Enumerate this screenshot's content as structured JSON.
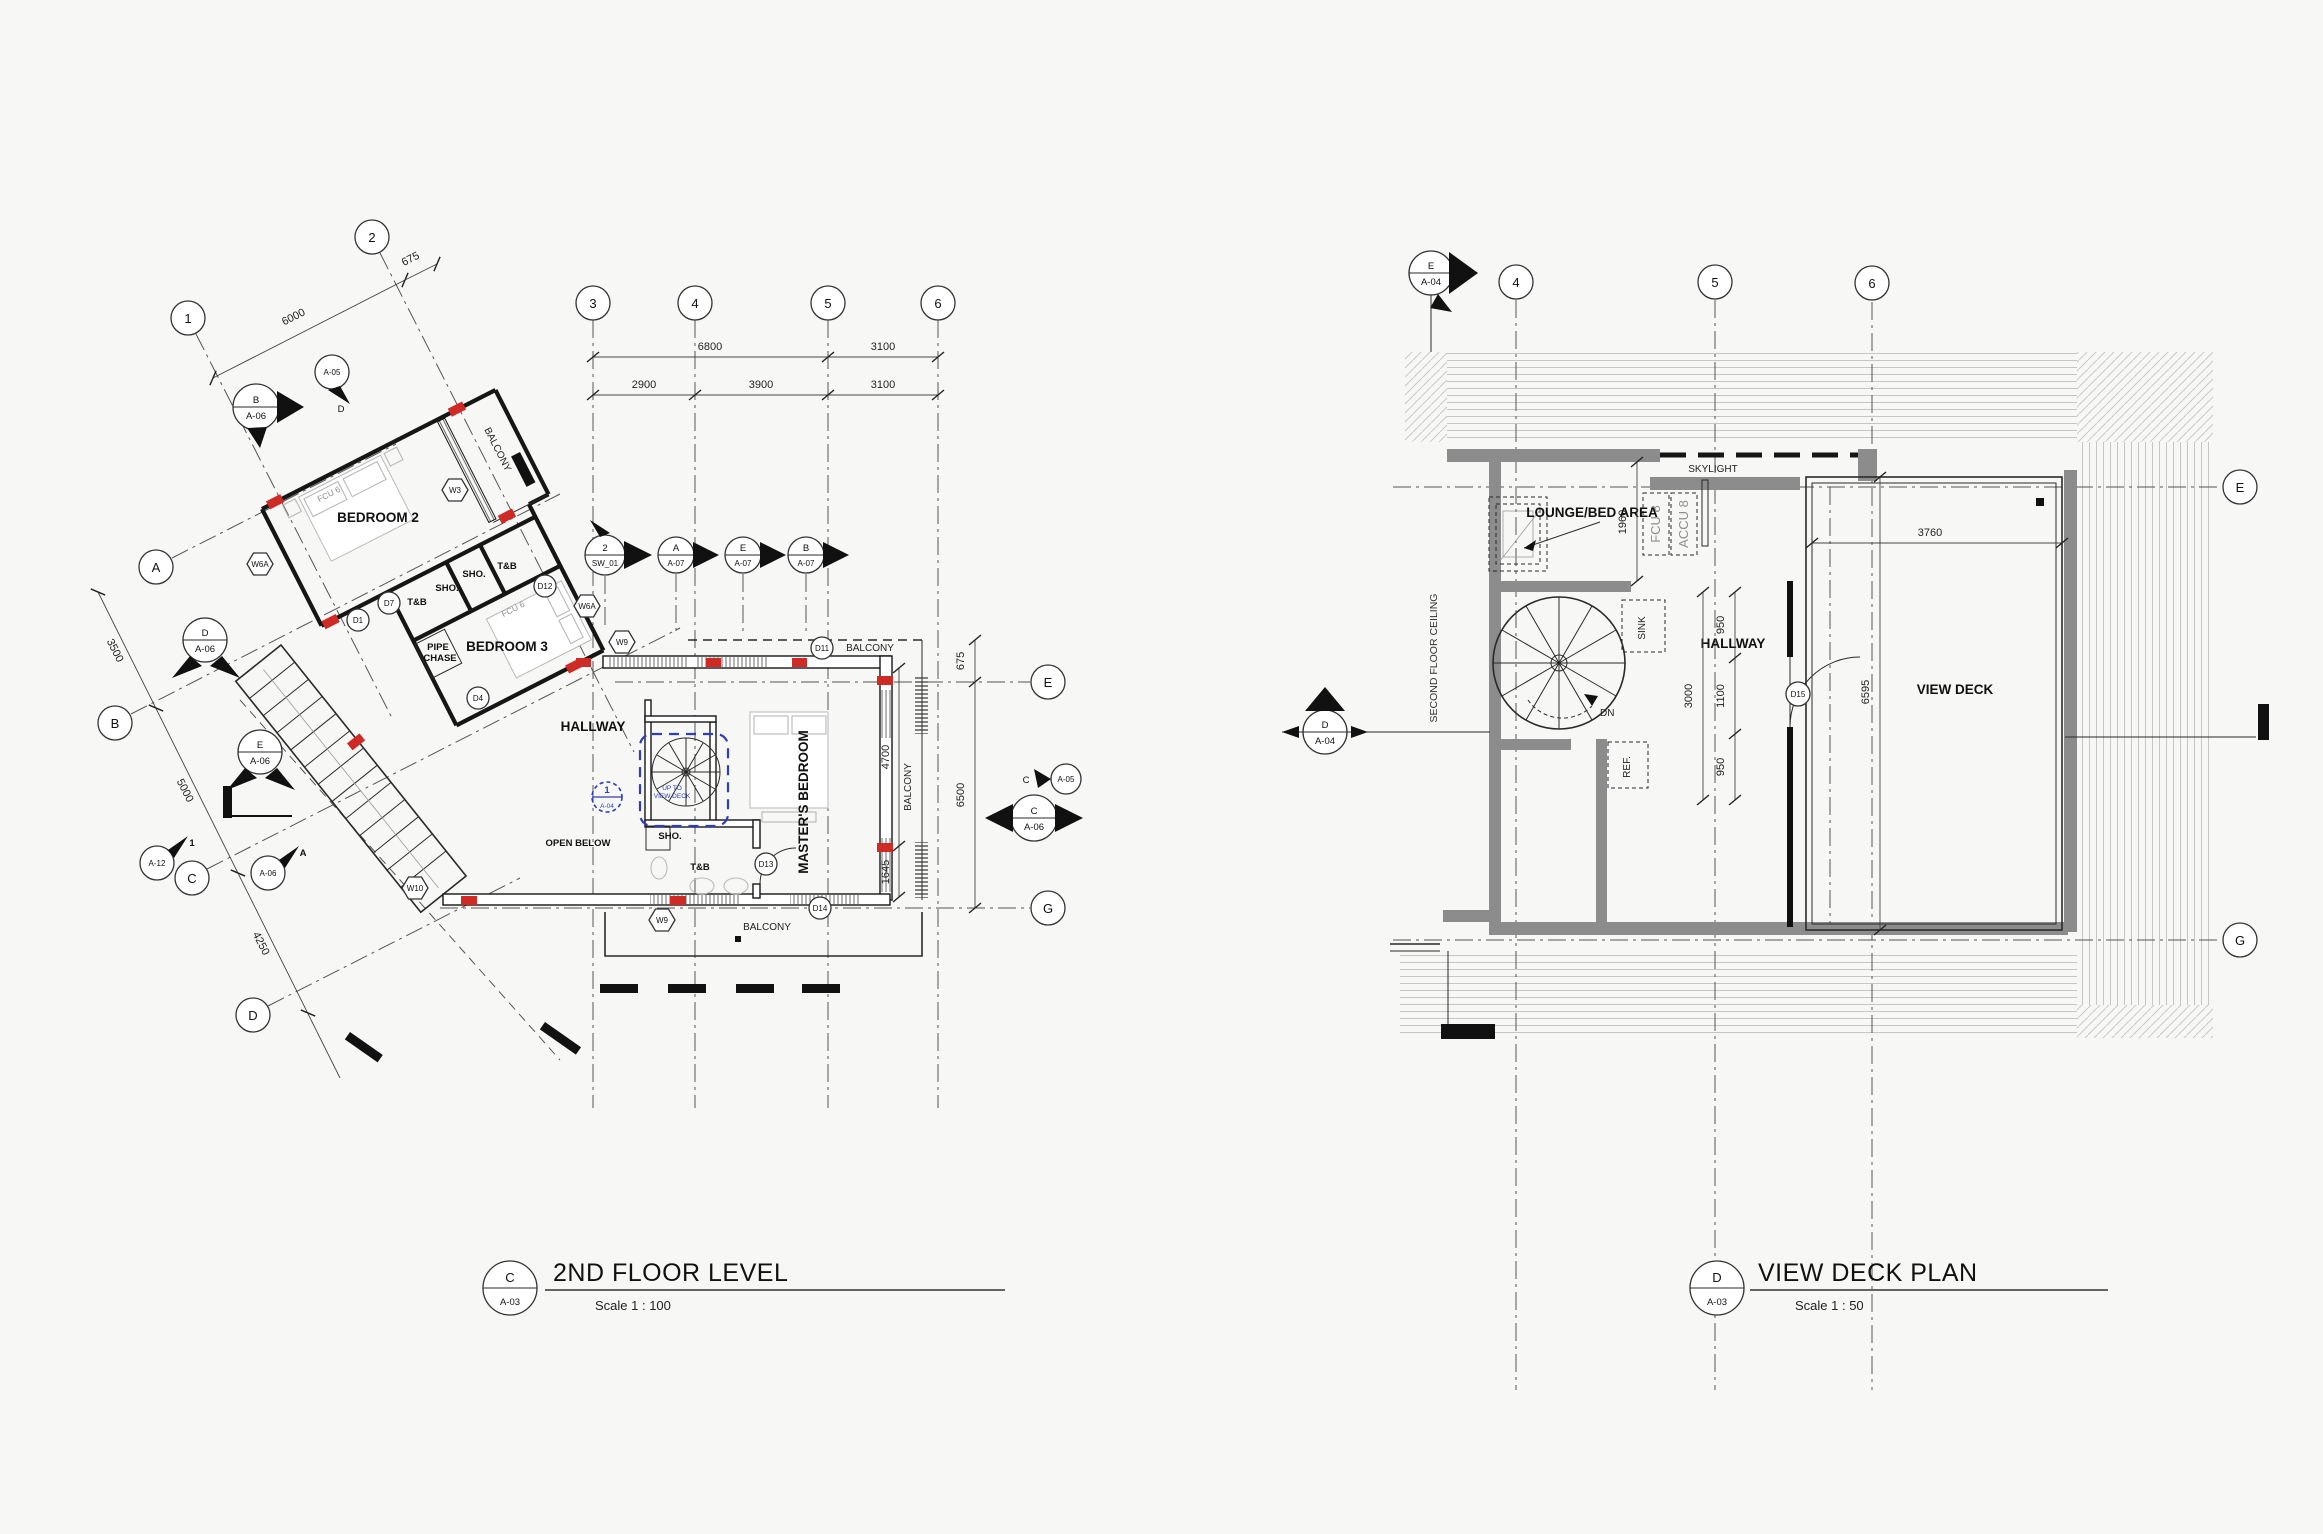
{
  "colors": {
    "red": "#cf2b26",
    "blue": "#2e3eb8",
    "wall_gray": "#8c8c8c",
    "hatch_gray": "#c6c6c6",
    "line": "#1a1a1a"
  },
  "left": {
    "title": {
      "ref": "C",
      "sheet": "A-03",
      "text": "2ND FLOOR LEVEL",
      "scale": "Scale  1 : 100"
    },
    "grids": {
      "n1": "1",
      "n2": "2",
      "n3": "3",
      "n4": "4",
      "n5": "5",
      "n6": "6",
      "la": "A",
      "lb": "B",
      "lc": "C",
      "ld": "D",
      "le": "E",
      "lg": "G"
    },
    "dims": {
      "top6800": "6800",
      "top3100": "3100",
      "r2900": "2900",
      "r3900": "3900",
      "r3100": "3100",
      "d6000": "6000",
      "d675a": "675",
      "d3500": "3500",
      "d5000": "5000",
      "d4250": "4250",
      "d675b": "675",
      "d6500": "6500",
      "d4700": "4700",
      "d1645": "1645"
    },
    "rooms": {
      "bedroom2": "BEDROOM 2",
      "tb1": "T&B",
      "sho1": "SHO.",
      "sho2": "SHO.",
      "tb2": "T&B",
      "bedroom3": "BEDROOM 3",
      "pipe1": "PIPE",
      "pipe2": "CHASE",
      "hallway": "HALLWAY",
      "open_below": "OPEN BELOW",
      "master": "MASTER'S BEDROOM",
      "tb3": "T&B",
      "sho3": "SHO.",
      "balcony_wing": "BALCONY",
      "balcony_top": "BALCONY",
      "balcony_right": "BALCONY",
      "balcony_bottom": "BALCONY",
      "fcu_a": "FCU 6",
      "fcu_b": "FCU 6"
    },
    "notes": {
      "up1": "UP TO",
      "up2": "VIEW DECK"
    },
    "markers": {
      "b_a06": [
        "B",
        "A-06"
      ],
      "a05d": [
        "A-05",
        "D"
      ],
      "d_a06": [
        "D",
        "A-06"
      ],
      "e_a06": [
        "E",
        "A-06"
      ],
      "a12": [
        "A-12",
        "1"
      ],
      "a06a": [
        "A-06",
        "A"
      ],
      "c_a06": [
        "C",
        "A-06"
      ],
      "a05c": [
        "A-05",
        "C"
      ],
      "sw01": [
        "2",
        "SW_01"
      ],
      "a07a": [
        "A",
        "A-07"
      ],
      "a07e": [
        "E",
        "A-07"
      ],
      "a07b": [
        "B",
        "A-07"
      ],
      "blue1": [
        "1",
        "A-04"
      ]
    },
    "tags": {
      "w3": "W3",
      "w6a1": "W6A",
      "w6a2": "W6A",
      "w9a": "W9",
      "w9b": "W9",
      "w10": "W10",
      "d1": "D1",
      "d4": "D4",
      "d7": "D7",
      "d11": "D11",
      "d12": "D12",
      "d13": "D13",
      "d14": "D14"
    }
  },
  "right": {
    "title": {
      "ref": "D",
      "sheet": "A-03",
      "text": "VIEW DECK PLAN",
      "scale": "Scale  1 : 50"
    },
    "grids": {
      "n4": "4",
      "n5": "5",
      "n6": "6",
      "le": "E",
      "lg": "G"
    },
    "markers": {
      "e_a04": [
        "E",
        "A-04"
      ],
      "d_a04": [
        "D",
        "A-04"
      ]
    },
    "rooms": {
      "lounge": "LOUNGE/BED AREA",
      "skylight": "SKYLIGHT",
      "fcu": "FCU 8",
      "accu": "ACCU 8",
      "hallway": "HALLWAY",
      "sink": "SINK",
      "ref": "REF.",
      "dn": "DN",
      "viewdeck": "VIEW DECK",
      "ceiling": "SECOND FLOOR CEILING"
    },
    "dims": {
      "d1960": "1960",
      "d3760": "3760",
      "d950a": "950",
      "d1100": "1100",
      "d950b": "950",
      "d3000": "3000",
      "d6595": "6595"
    },
    "tags": {
      "d15": "D15"
    }
  }
}
